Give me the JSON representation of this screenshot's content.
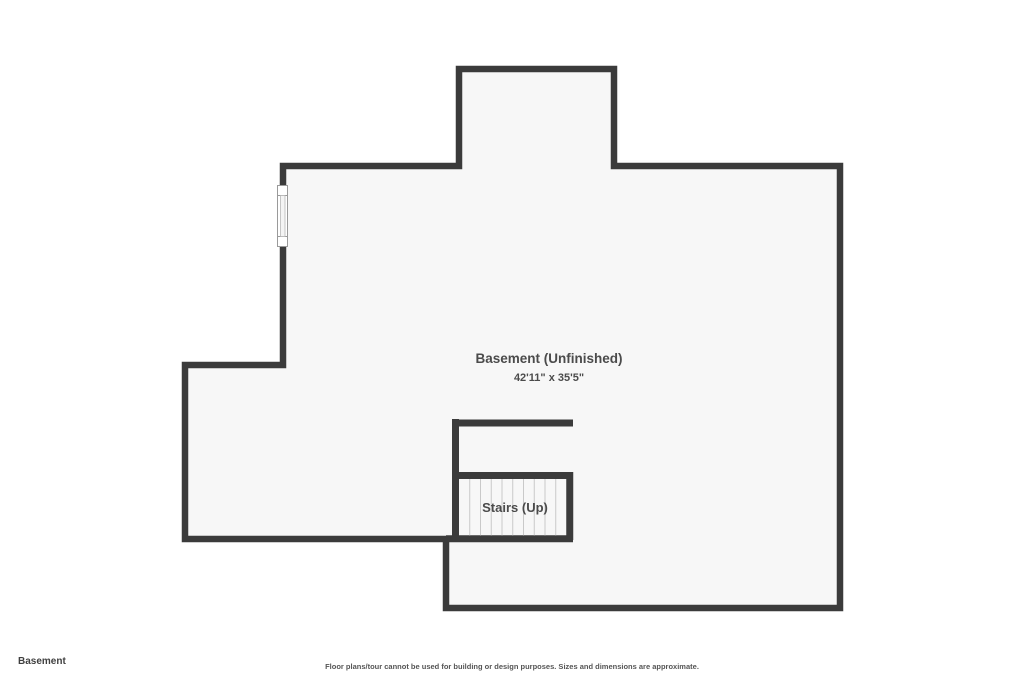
{
  "plan": {
    "floor_label": "Basement",
    "disclaimer": "Floor plans/tour cannot be used for building or design purposes. Sizes and dimensions are approximate.",
    "rooms": {
      "basement": {
        "name": "Basement (Unfinished)",
        "dimensions": "42'11\" x 35'5\""
      },
      "stairs": {
        "name": "Stairs (Up)"
      }
    },
    "features": {
      "window_count": 1,
      "stair_tread_count": 10
    },
    "colors": {
      "wall": "#3b3b3b",
      "room_fill": "#f7f7f7",
      "background": "#ffffff",
      "label_text": "#4b4b4b",
      "tread_line": "#c9c9c9",
      "window_border": "#9a9a9a"
    }
  }
}
